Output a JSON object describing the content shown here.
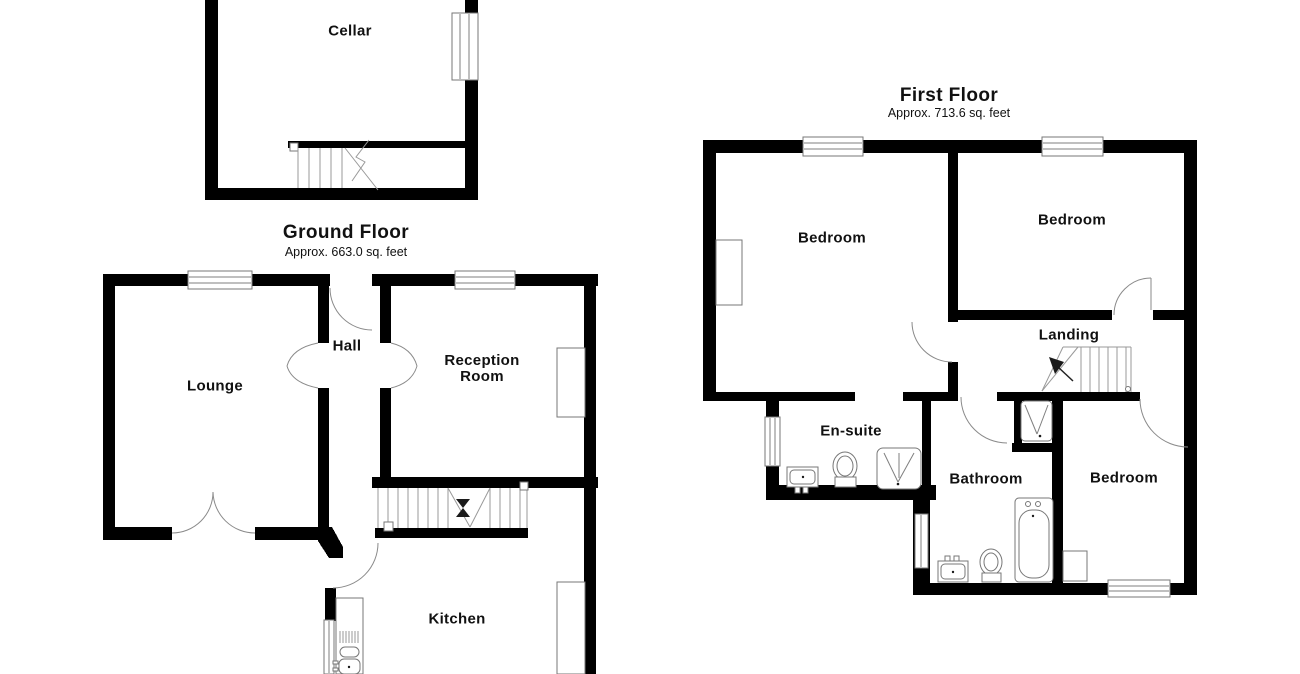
{
  "document": {
    "type": "property-floorplan",
    "background_color": "#ffffff",
    "wall_color": "#000000",
    "line_color": "#7f7f7f",
    "text_color": "#111111"
  },
  "floors": {
    "cellar": {
      "rooms": {
        "cellar": "Cellar"
      }
    },
    "ground": {
      "title": "Ground Floor",
      "subtitle": "Approx. 663.0 sq. feet",
      "rooms": {
        "lounge": "Lounge",
        "hall": "Hall",
        "reception": "Reception Room",
        "kitchen": "Kitchen"
      }
    },
    "first": {
      "title": "First Floor",
      "subtitle": "Approx. 713.6 sq. feet",
      "rooms": {
        "bedroom1": "Bedroom",
        "bedroom2": "Bedroom",
        "landing": "Landing",
        "ensuite": "En-suite",
        "bathroom": "Bathroom",
        "bedroom3": "Bedroom"
      }
    }
  },
  "fixtures": [
    "staircase",
    "direction-arrow",
    "window",
    "door-swing",
    "archway",
    "bathtub",
    "toilet",
    "washbasin",
    "shower-tray",
    "kitchen-sink",
    "worktop",
    "wardrobe",
    "chimney-recess"
  ]
}
